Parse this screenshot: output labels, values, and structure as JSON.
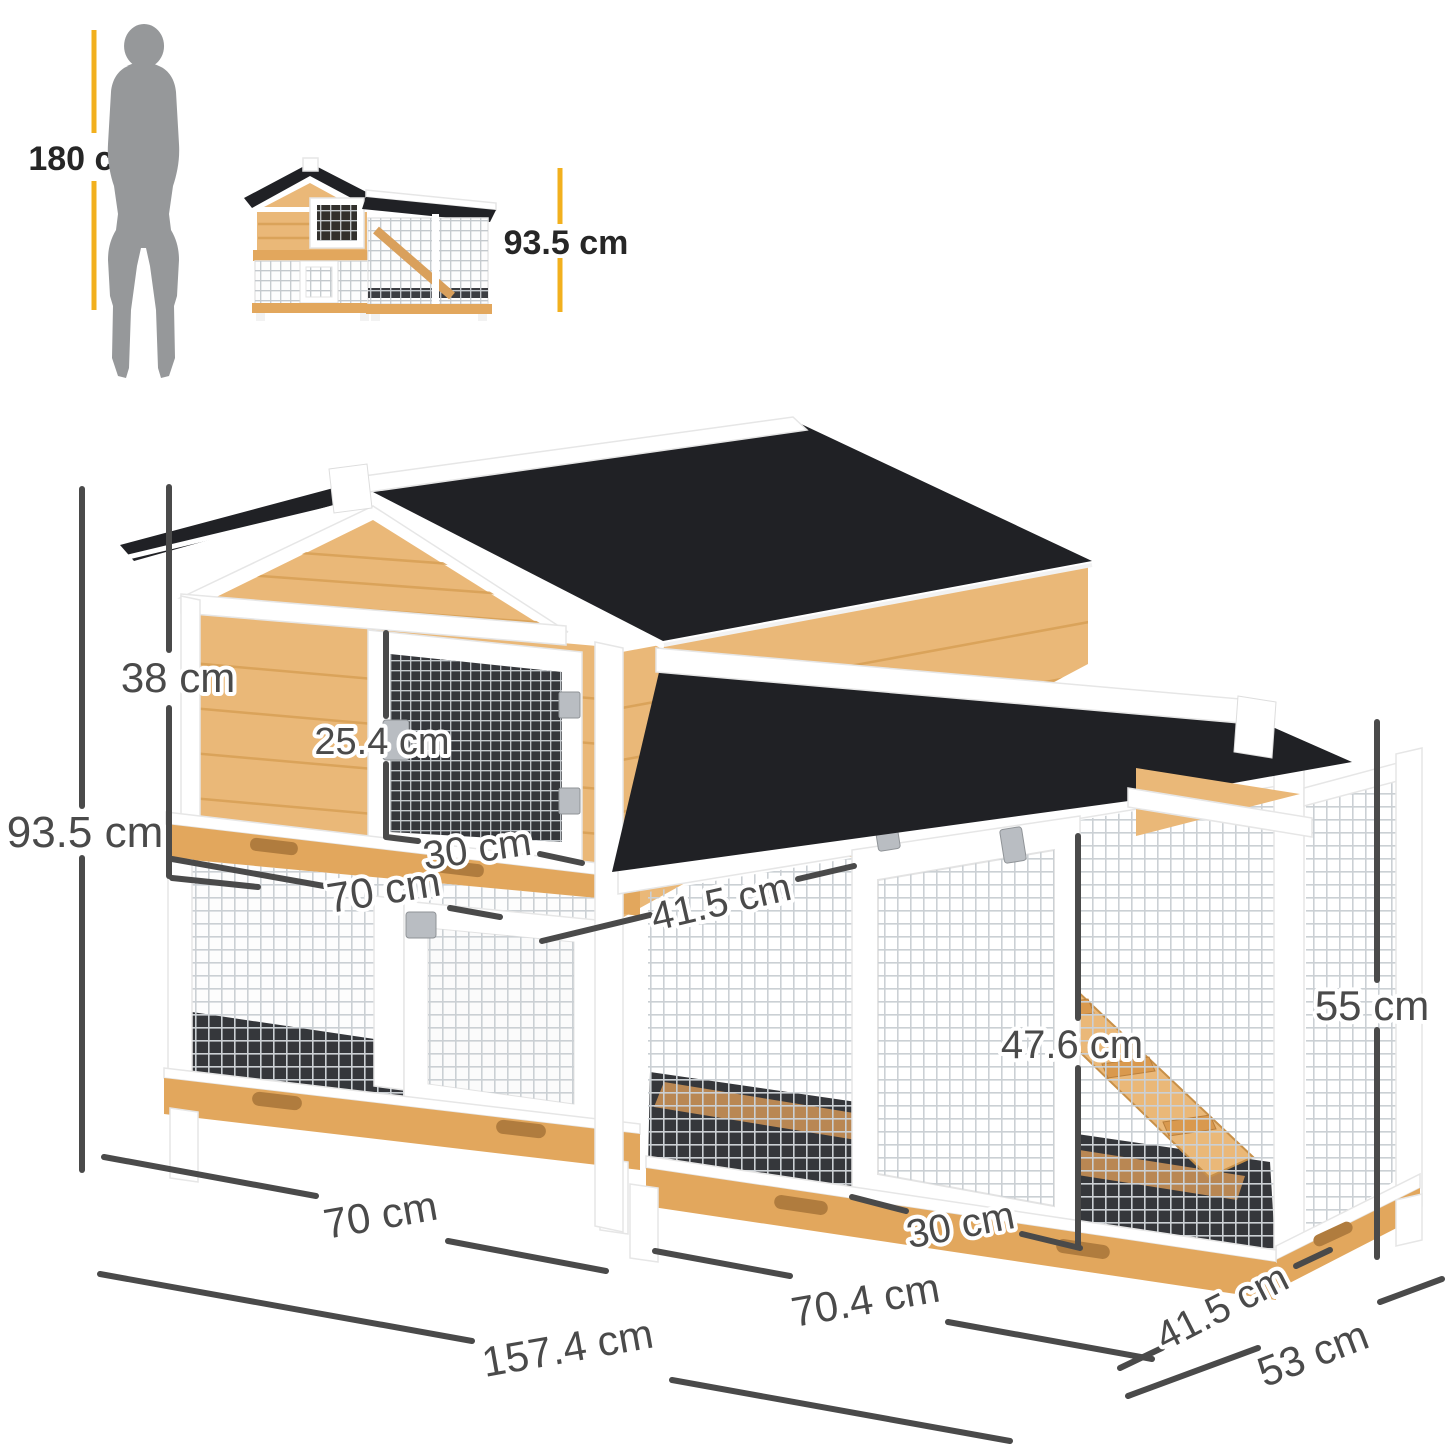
{
  "title": "Rabbit hutch dimension diagram",
  "scale_reference": {
    "person_height_label": "180 cm",
    "product_height_label": "93.5 cm"
  },
  "dimensions": {
    "total_height": "93.5 cm",
    "upper_house_height": "38 cm",
    "upper_door_height": "25.4 cm",
    "upper_door_width": "30 cm",
    "upper_house_width": "70 cm",
    "platform_depth": "41.5 cm",
    "ramp_length": "47.6 cm",
    "run_height": "55 cm",
    "lower_left_width": "70 cm",
    "run_door_width": "30 cm",
    "overall_width": "157.4 cm",
    "run_width": "70.4 cm",
    "run_depth": "41.5 cm",
    "overall_depth": "53 cm"
  },
  "colors": {
    "accent_yellow": "#F2B01E",
    "dimension_gray": "#4A4A4A",
    "silhouette_gray": "#96989A",
    "roof_black": "#202125",
    "wood_light": "#EAB878",
    "wood_mid": "#E2A75D",
    "wood_dark": "#B07C3E",
    "frame_white": "#FFFFFF",
    "interior_dark": "#35373B",
    "mesh_gray": "#CBD0D4"
  }
}
